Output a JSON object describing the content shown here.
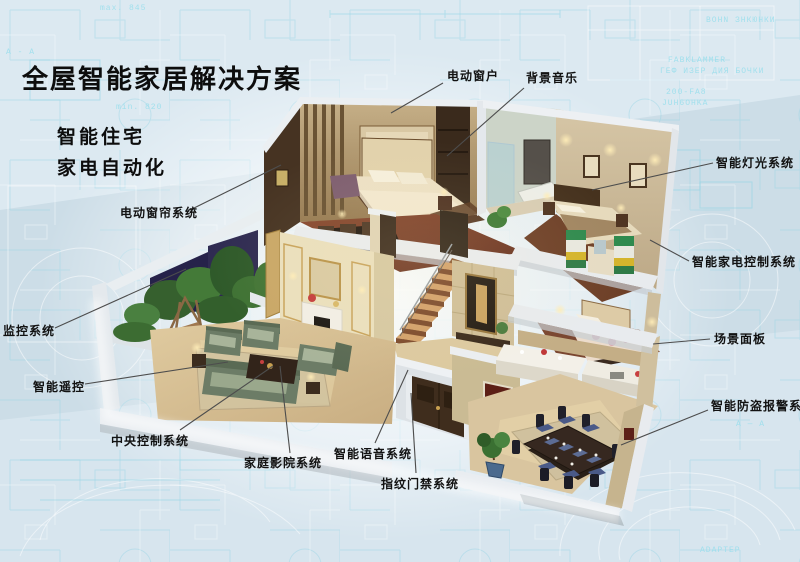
{
  "title": {
    "text": "全屋智能家居解决方案"
  },
  "subtitles": [
    {
      "text": "智能住宅"
    },
    {
      "text": "家电自动化"
    }
  ],
  "callouts": [
    {
      "label": "电动窗户",
      "x": 447,
      "y": 67,
      "x1": 443,
      "y1": 83,
      "x2": 391,
      "y2": 113
    },
    {
      "label": "背景音乐",
      "x": 526,
      "y": 69,
      "x1": 524,
      "y1": 88,
      "x2": 447,
      "y2": 156
    },
    {
      "label": "智能灯光系统",
      "x": 716,
      "y": 154,
      "x1": 713,
      "y1": 163,
      "x2": 592,
      "y2": 190
    },
    {
      "label": "智能家电控制系统",
      "x": 692,
      "y": 253,
      "x1": 689,
      "y1": 261,
      "x2": 650,
      "y2": 240
    },
    {
      "label": "场景面板",
      "x": 714,
      "y": 330,
      "x1": 710,
      "y1": 339,
      "x2": 653,
      "y2": 344
    },
    {
      "label": "智能防盗报警系统",
      "x": 711,
      "y": 397,
      "x1": 708,
      "y1": 410,
      "x2": 621,
      "y2": 445
    },
    {
      "label": "电动窗帘系统",
      "x": 120,
      "y": 204,
      "x1": 190,
      "y1": 210,
      "x2": 281,
      "y2": 165
    },
    {
      "label": "监控系统",
      "x": 3,
      "y": 322,
      "x1": 55,
      "y1": 328,
      "x2": 186,
      "y2": 269
    },
    {
      "label": "智能遥控",
      "x": 33,
      "y": 378,
      "x1": 85,
      "y1": 384,
      "x2": 228,
      "y2": 362
    },
    {
      "label": "中央控制系统",
      "x": 111,
      "y": 432,
      "x1": 180,
      "y1": 430,
      "x2": 273,
      "y2": 366
    },
    {
      "label": "家庭影院系统",
      "x": 244,
      "y": 454,
      "x1": 290,
      "y1": 453,
      "x2": 280,
      "y2": 366
    },
    {
      "label": "智能语音系统",
      "x": 334,
      "y": 445,
      "x1": 375,
      "y1": 443,
      "x2": 408,
      "y2": 370
    },
    {
      "label": "指纹门禁系统",
      "x": 381,
      "y": 475,
      "x1": 416,
      "y1": 473,
      "x2": 411,
      "y2": 393
    }
  ],
  "blueprint_words": [
    {
      "text": "max. 845",
      "x": 100,
      "y": 4
    },
    {
      "text": "A - A",
      "x": 6,
      "y": 48
    },
    {
      "text": "min. 820",
      "x": 116,
      "y": 103
    },
    {
      "text": "BOHN ЗНКЮНКИ",
      "x": 706,
      "y": 16
    },
    {
      "text": "FABKLAMMER",
      "x": 668,
      "y": 56
    },
    {
      "text": "ГЕФ ИЗЕР ДИЯ БОЧКИ",
      "x": 660,
      "y": 67
    },
    {
      "text": "200-FA8",
      "x": 666,
      "y": 88
    },
    {
      "text": "JUH6OHKA",
      "x": 662,
      "y": 99
    },
    {
      "text": "A — A",
      "x": 736,
      "y": 420
    },
    {
      "text": "ADAPTEP",
      "x": 700,
      "y": 546
    }
  ],
  "colors": {
    "background": "#ccdde7",
    "blueprint": "#9fd8e8",
    "label_text": "#121212",
    "leader_line": "#4d4d4d",
    "title_text": "#0d0d0d"
  }
}
